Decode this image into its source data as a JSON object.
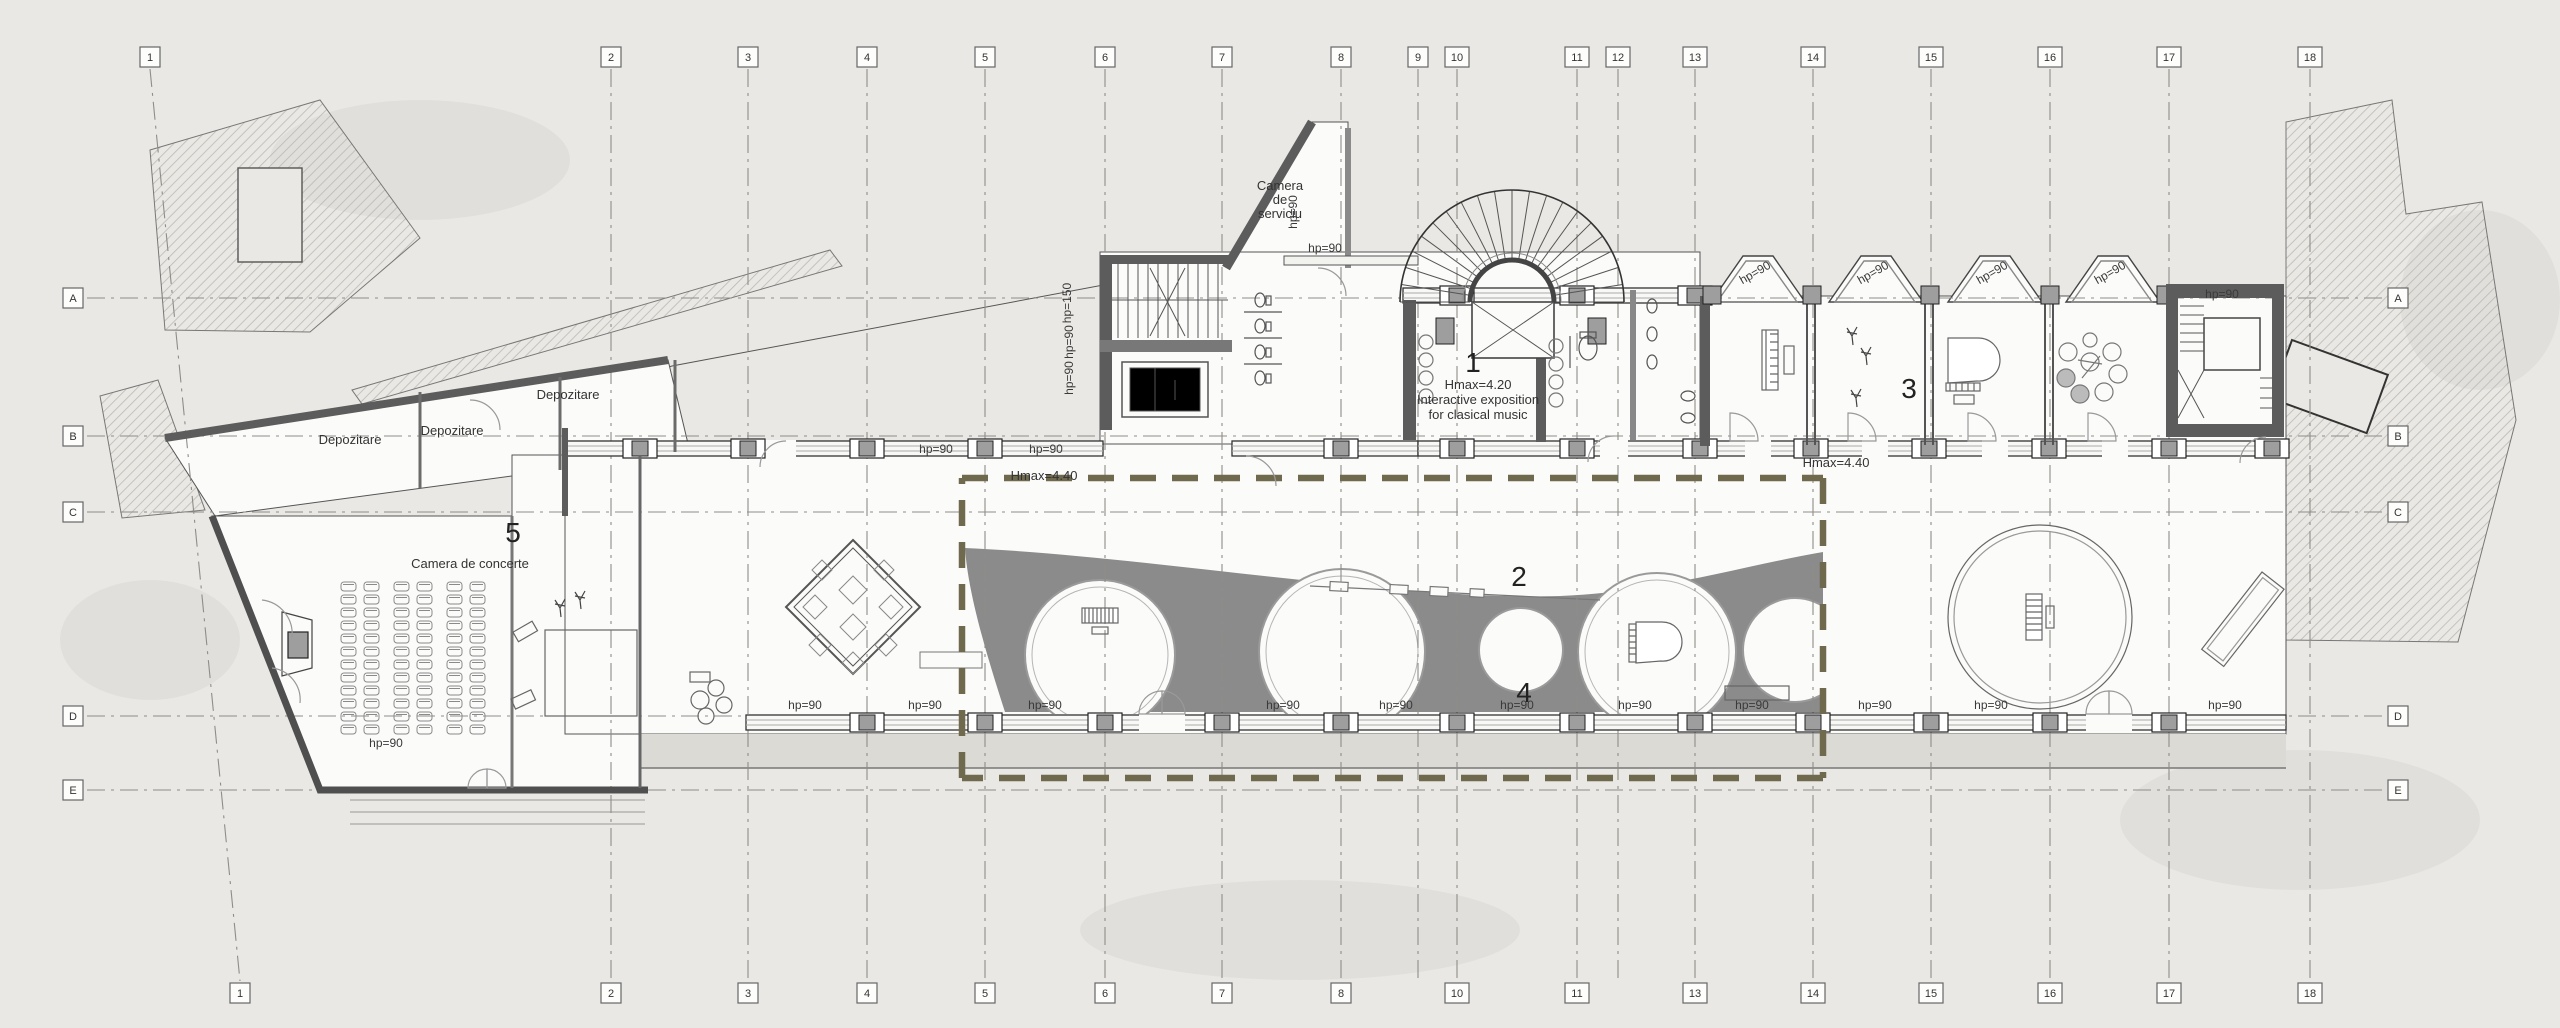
{
  "grid": {
    "columns": [
      {
        "label": "1",
        "x": 150,
        "xBottom": 240
      },
      {
        "label": "2",
        "x": 611
      },
      {
        "label": "3",
        "x": 748
      },
      {
        "label": "4",
        "x": 867
      },
      {
        "label": "5",
        "x": 985
      },
      {
        "label": "6",
        "x": 1105
      },
      {
        "label": "7",
        "x": 1222
      },
      {
        "label": "8",
        "x": 1341
      },
      {
        "label": "9",
        "x": 1418,
        "bottom": false
      },
      {
        "label": "10",
        "x": 1457
      },
      {
        "label": "11",
        "x": 1577
      },
      {
        "label": "12",
        "x": 1618,
        "bottom": false
      },
      {
        "label": "13",
        "x": 1695
      },
      {
        "label": "14",
        "x": 1813
      },
      {
        "label": "15",
        "x": 1931
      },
      {
        "label": "16",
        "x": 2050
      },
      {
        "label": "17",
        "x": 2169
      },
      {
        "label": "18",
        "x": 2310
      }
    ],
    "rows": [
      {
        "label": "A",
        "y": 298
      },
      {
        "label": "B",
        "y": 436
      },
      {
        "label": "C",
        "y": 512
      },
      {
        "label": "D",
        "y": 716
      },
      {
        "label": "E",
        "y": 790
      }
    ],
    "top_y": 57,
    "bottom_y": 993,
    "left_x": 73,
    "right_x": 2398
  },
  "room_numbers": [
    {
      "n": "1",
      "x": 1473,
      "y": 372
    },
    {
      "n": "2",
      "x": 1519,
      "y": 586
    },
    {
      "n": "3",
      "x": 1909,
      "y": 398
    },
    {
      "n": "4",
      "x": 1524,
      "y": 702
    },
    {
      "n": "5",
      "x": 513,
      "y": 542
    }
  ],
  "annotations": [
    {
      "text": "Hmax=4.20",
      "x": 1478,
      "y": 389,
      "size": 13
    },
    {
      "text": "Interactive exposition",
      "x": 1478,
      "y": 404,
      "size": 13
    },
    {
      "text": "for clasical music",
      "x": 1478,
      "y": 419,
      "size": 13
    },
    {
      "text": "Hmax=4.40",
      "x": 1044,
      "y": 480,
      "size": 13
    },
    {
      "text": "Hmax=4.40",
      "x": 1836,
      "y": 467,
      "size": 13
    },
    {
      "text": "Camera de concerte",
      "x": 470,
      "y": 568,
      "size": 12.5
    },
    {
      "text": "Depozitare",
      "x": 350,
      "y": 444,
      "size": 12
    },
    {
      "text": "Depozitare",
      "x": 452,
      "y": 435,
      "size": 12
    },
    {
      "text": "Depozitare",
      "x": 568,
      "y": 399,
      "size": 12
    }
  ],
  "camera_serviciu": {
    "lines": [
      "Camera",
      "de",
      "serviciu"
    ],
    "x": 1280,
    "y": 190,
    "line_h": 14
  },
  "dimension_labels": {
    "bottom_wall": {
      "text": "hp=90",
      "y": 709,
      "xs": [
        805,
        925,
        1045,
        1283,
        1396,
        1517,
        1635,
        1752,
        1875,
        1991,
        2225
      ]
    },
    "top_wall": {
      "text": "hp=90",
      "y": 453,
      "xs": [
        936,
        1046
      ]
    },
    "bays": {
      "text": "hp=90",
      "y": 276,
      "rot": -30,
      "xs": [
        1757,
        1875,
        1994,
        2112
      ]
    },
    "vertical": [
      {
        "text": "hp=150",
        "x": 1071,
        "y": 303
      },
      {
        "text": "hp=90",
        "x": 1073,
        "y": 342
      },
      {
        "text": "hp=90",
        "x": 1073,
        "y": 378
      },
      {
        "text": "hp=90",
        "x": 1297,
        "y": 212
      }
    ],
    "misc": [
      {
        "text": "hp=90",
        "x": 1325,
        "y": 252
      },
      {
        "text": "hp=90",
        "x": 2222,
        "y": 298
      },
      {
        "text": "hp=90",
        "x": 386,
        "y": 747
      }
    ]
  },
  "seating": {
    "rows": 12,
    "row_start_y": 582,
    "row_step": 13,
    "col_xs": [
      341,
      364,
      394,
      417,
      447,
      470
    ],
    "seat_w": 15,
    "seat_h": 9
  },
  "colors": {
    "paper": "#e9e8e4",
    "canopy_gray": "#8b8b8b",
    "dashed_zone_olive": "#6f6a4e",
    "wall_dark": "#5c5c5c",
    "pier_gray": "#9e9e9e",
    "pavement": "#dcdad5",
    "hatch": "#bcb9b1"
  }
}
